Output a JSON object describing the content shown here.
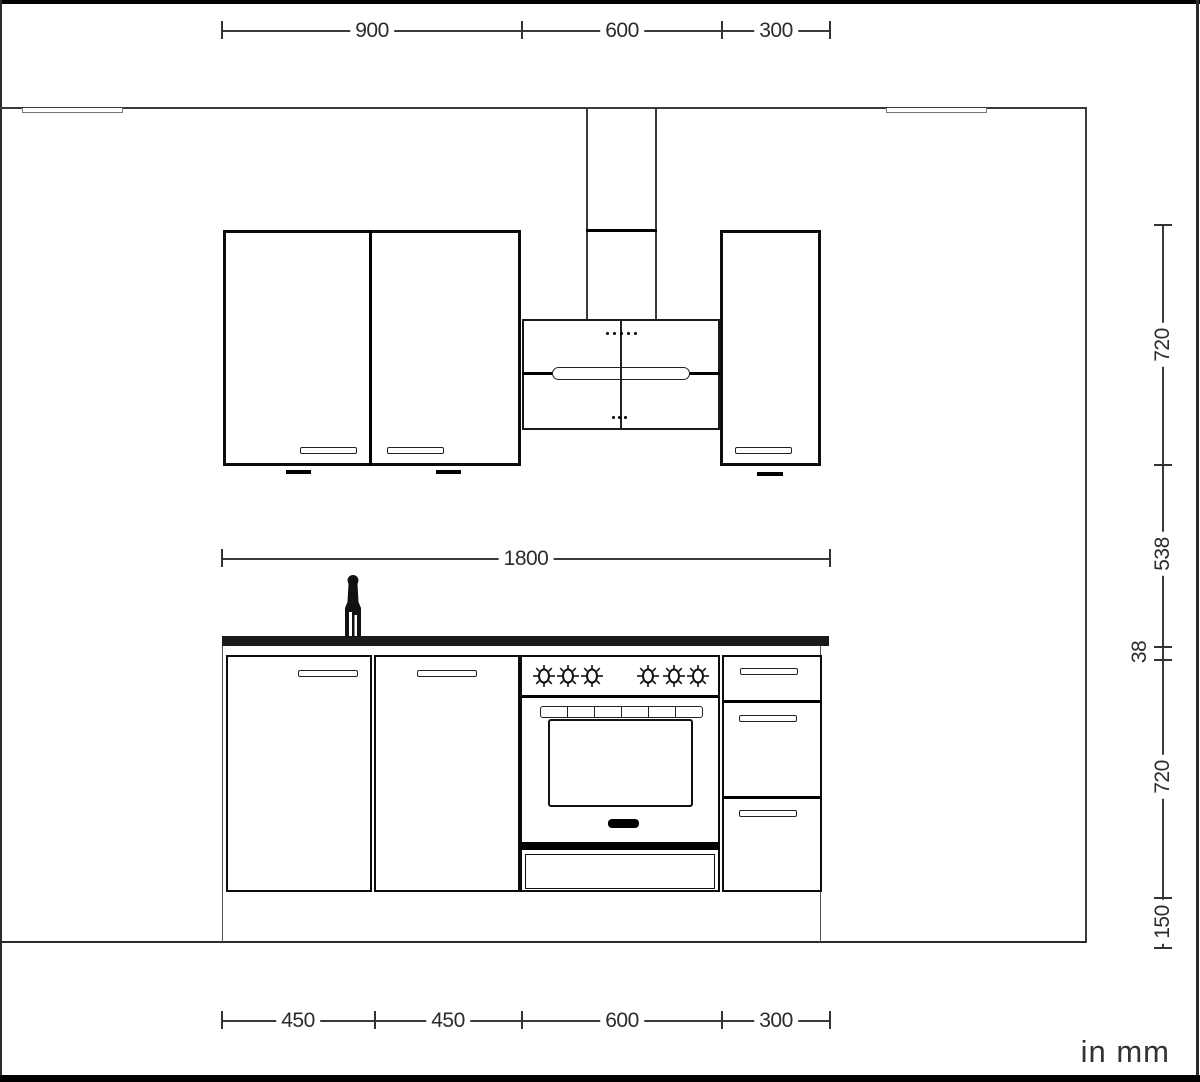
{
  "drawing": {
    "units_note": "in mm",
    "dim_top_segments": [
      "900",
      "600",
      "300"
    ],
    "dim_total_width": "1800",
    "dim_right_segments": [
      "720",
      "538",
      "38",
      "720",
      "150"
    ],
    "dim_bottom_segments": [
      "450",
      "450",
      "600",
      "300"
    ]
  },
  "colors": {
    "line": "#3a3a3a",
    "bold_line": "#000000",
    "countertop": "#1b1b1b",
    "background": "#ffffff"
  }
}
